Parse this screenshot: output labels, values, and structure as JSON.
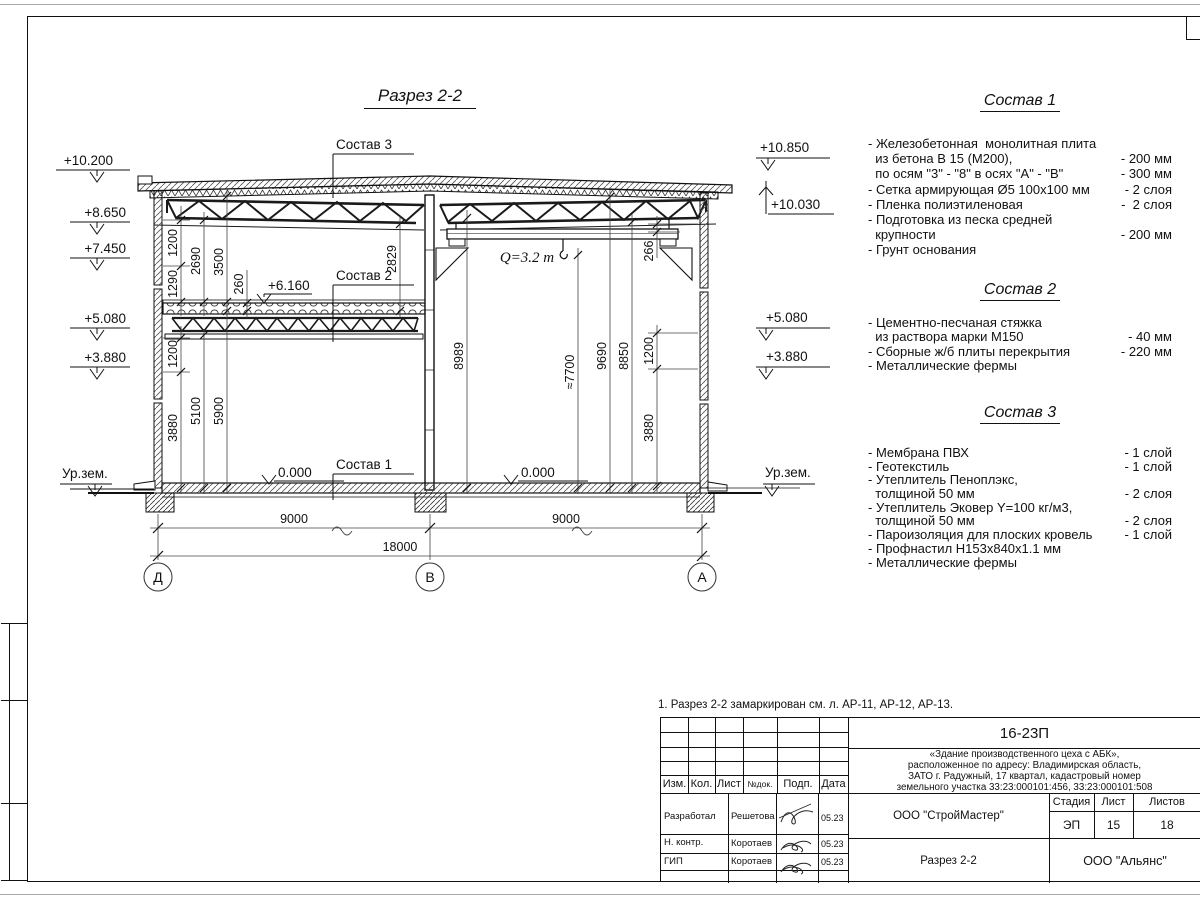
{
  "drawing": {
    "title": "Разрез 2-2",
    "crane_label": "Q=3.2 т",
    "plus6160": "+6.160",
    "zero_label": "0.000",
    "ground_label": "Ур.зем.",
    "levels_left": [
      "+10.200",
      "+8.650",
      "+7.450",
      "+5.080",
      "+3.880"
    ],
    "levels_right": [
      "+10.850",
      "+10.030",
      "+5.080",
      "+3.880"
    ],
    "leaders": [
      "Состав 3",
      "Состав 2",
      "Состав 1"
    ],
    "axes": [
      "Д",
      "В",
      "А"
    ],
    "dims_bottom": [
      "9000",
      "9000",
      "18000"
    ],
    "dims_left_upper": [
      "1200",
      "1290",
      "2690",
      "3500",
      "260",
      "2829"
    ],
    "dims_left_lower": [
      "1200",
      "3880",
      "5100",
      "5900"
    ],
    "dims_right": [
      "8989",
      "≈7700",
      "9690",
      "8850",
      "266",
      "1200",
      "3880"
    ]
  },
  "compositions": [
    {
      "title": "Состав 1",
      "rows": [
        {
          "t": "- Железобетонная  монолитная плита",
          "v": ""
        },
        {
          "t": "  из бетона В 15 (М200),",
          "v": "- 200 мм"
        },
        {
          "t": "  по осям \"3\" - \"8\" в осях \"А\" - \"В\"",
          "v": "- 300 мм"
        },
        {
          "t": "- Сетка армирующая Ø5 100х100 мм",
          "v": "- 2 слоя"
        },
        {
          "t": "- Пленка полиэтиленовая",
          "v": "-  2 слоя"
        },
        {
          "t": "- Подготовка из песка средней",
          "v": ""
        },
        {
          "t": "  крупности",
          "v": "- 200 мм"
        },
        {
          "t": "- Грунт основания",
          "v": ""
        }
      ]
    },
    {
      "title": "Состав 2",
      "rows": [
        {
          "t": "- Цементно-песчаная стяжка",
          "v": ""
        },
        {
          "t": "  из раствора марки М150",
          "v": "- 40 мм"
        },
        {
          "t": "- Сборные ж/б плиты перекрытия",
          "v": "- 220 мм"
        },
        {
          "t": "- Металлические фермы",
          "v": ""
        }
      ]
    },
    {
      "title": "Состав 3",
      "rows": [
        {
          "t": "- Мембрана ПВХ",
          "v": "- 1 слой"
        },
        {
          "t": "- Геотекстиль",
          "v": "- 1 слой"
        },
        {
          "t": "- Утеплитель Пеноплэкс,",
          "v": ""
        },
        {
          "t": "  толщиной 50 мм",
          "v": "- 2 слоя"
        },
        {
          "t": "- Утеплитель Эковер Y=100 кг/м3,",
          "v": ""
        },
        {
          "t": "  толщиной 50 мм",
          "v": "- 2 слоя"
        },
        {
          "t": "- Пароизоляция для плоских кровель",
          "v": "- 1 слой"
        },
        {
          "t": "- Профнастил Н153х840х1.1 мм",
          "v": ""
        },
        {
          "t": "- Металлические фермы",
          "v": ""
        }
      ]
    }
  ],
  "note": "1. Разрез 2-2 замаркирован см. л. АР-11, АР-12, АР-13.",
  "titleblock": {
    "doc_code": "16-23П",
    "description": [
      "«Здание производственного цеха с АБК»,",
      "расположенное по адресу: Владимирская область,",
      "ЗАТО г. Радужный, 17 квартал, кадастровый номер",
      "земельного участка 33:23:000101:456, 33:23:000101:508"
    ],
    "headers": [
      "Изм.",
      "Кол.",
      "Лист",
      "№док.",
      "Подп.",
      "Дата"
    ],
    "rows": [
      {
        "role": "Разработал",
        "name": "Решетова",
        "date": "05.23"
      },
      {
        "role": "Н. контр.",
        "name": "Коротаев",
        "date": "05.23"
      },
      {
        "role": "ГИП",
        "name": "Коротаев",
        "date": "05.23"
      }
    ],
    "contractor": "ООО \"СтройМастер\"",
    "stage_label": "Стадия",
    "sheet_label": "Лист",
    "sheets_label": "Листов",
    "stage": "ЭП",
    "sheet": "15",
    "sheets": "18",
    "subject": "Разрез 2-2",
    "company": "ООО \"Альянс\""
  }
}
